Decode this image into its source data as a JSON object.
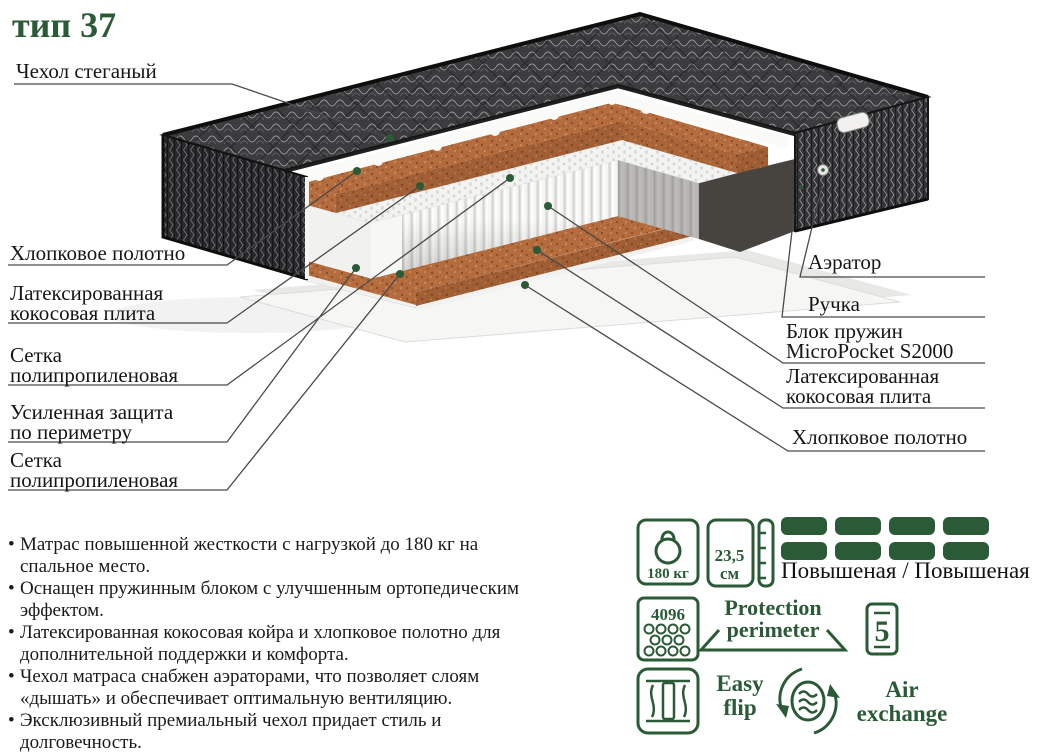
{
  "title": "тип 37",
  "colors": {
    "accent": "#2a5a36",
    "text": "#1a1a1a",
    "leader_line": "#4a4a4a",
    "coir": "#b46c3e",
    "quilt_dark": "#3a3a3c",
    "spring_white": "#f4f4f2"
  },
  "diagram": {
    "left_labels": [
      "Чехол стеганый",
      "Хлопковое полотно",
      "Латексированная\nкокосовая плита",
      "Сетка\nполипропиленовая",
      "Усиленная защита\nпо периметру",
      "Сетка\nполипропиленовая"
    ],
    "right_labels": [
      "Аэратор",
      "Ручка",
      "Блок пружин\nMicroPocket S2000",
      "Латексированная\nкокосовая плита",
      "Хлопковое полотно"
    ]
  },
  "features": [
    "Матрас повышенной жесткости с нагрузкой до 180 кг на\nспальное место.",
    "Оснащен пружинным блоком с улучшенным ортопедическим\nэффектом.",
    "Латексированная кокосовая койра и хлопковое полотно для\nдополнительной поддержки и комфорта.",
    "Чехол матраса снабжен аэраторами, что позволяет слоям\n«дышать» и обеспечивает оптимальную вентиляцию.",
    "Эксклюзивный премиальный чехол придает стиль и\nдолговечность."
  ],
  "specs": {
    "max_load": "180 кг",
    "height": "23,5\nсм",
    "firmness_label": "Повышеная / Повышеная",
    "springs_count": "4096",
    "protection": "Protection\nperimeter",
    "warranty_years": "5",
    "easy_flip": "Easy\nflip",
    "air_exchange": "Air\nexchange"
  }
}
